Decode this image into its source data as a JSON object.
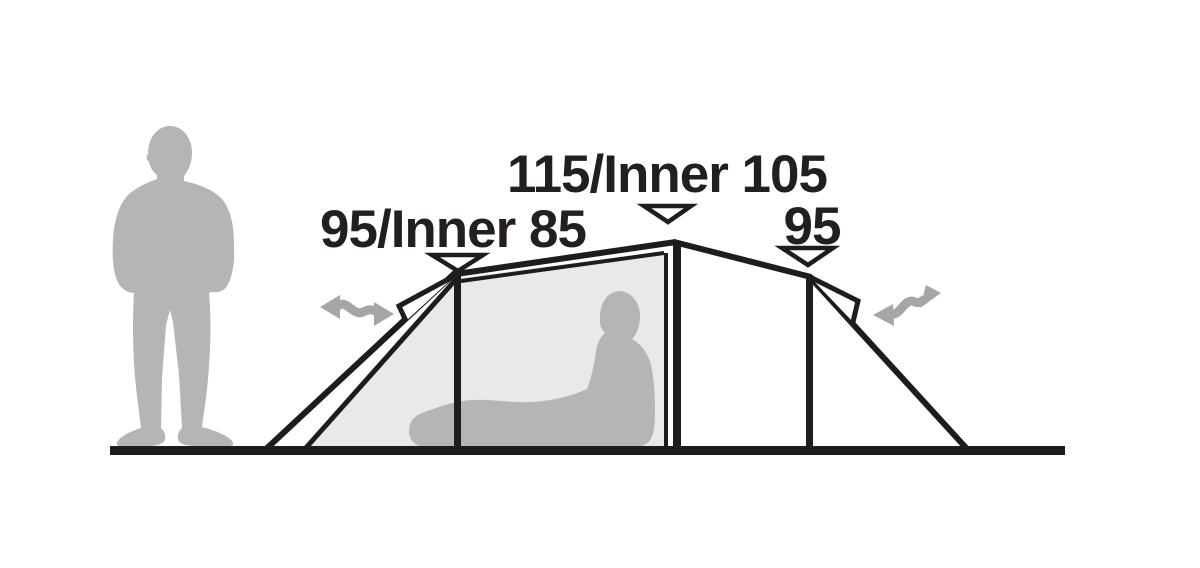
{
  "diagram": {
    "subject": "tent-side-profile-height-dimensions",
    "measurements": {
      "left": {
        "label": "95/Inner 85"
      },
      "center": {
        "label": "115/Inner 105"
      },
      "right": {
        "label": "95"
      }
    },
    "icons": {
      "height_marker": "triangle-down-marker",
      "entrance_arrow": "double-headed-wavy-arrow",
      "scale_figure": "standing-person-silhouette",
      "occupant_figure": "sitting-person-silhouette"
    },
    "colors": {
      "line": "#1d1d1b",
      "text": "#231f20",
      "silhouette_gray": "#b5b5b5",
      "inner_panel_gray": "#e9e9e9",
      "arrow_gray": "#a6a6a6",
      "marker_fill": "#ffffff",
      "background": "#ffffff"
    }
  }
}
